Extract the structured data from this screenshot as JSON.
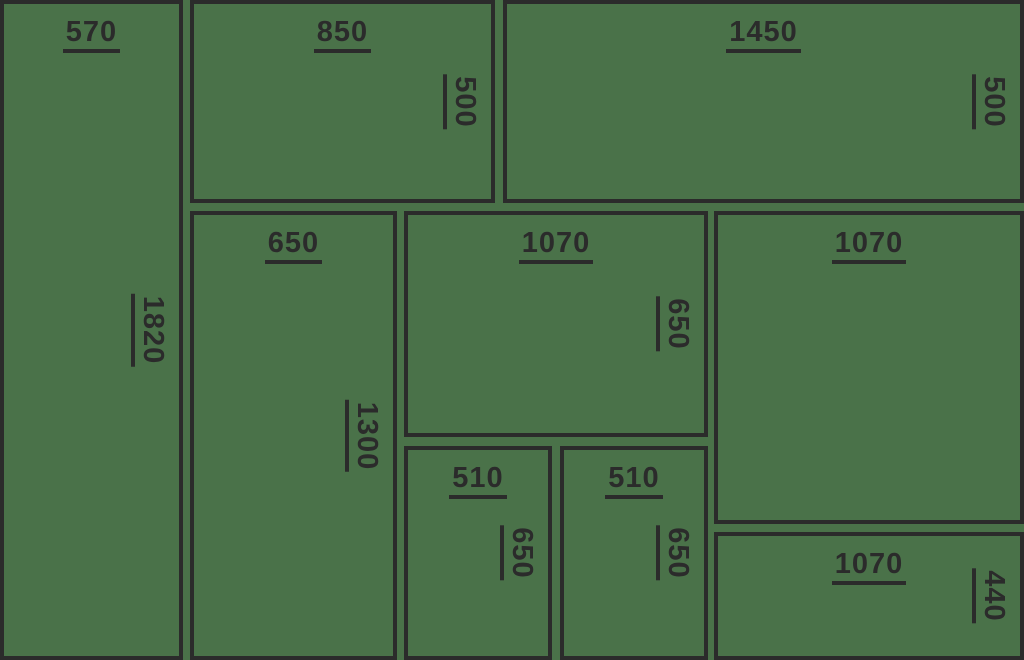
{
  "canvas": {
    "width_px": 1024,
    "height_px": 660,
    "background_color": "#4a7249",
    "line_color": "#2b2b2b"
  },
  "diagram": {
    "type": "panel-cutting-layout",
    "panels": [
      {
        "name": "panel-570x1820",
        "width_label": "570",
        "height_label": "1820",
        "x": 0,
        "y": 0,
        "w": 183,
        "h": 660
      },
      {
        "name": "panel-850x500",
        "width_label": "850",
        "height_label": "500",
        "x": 190,
        "y": 0,
        "w": 305,
        "h": 203
      },
      {
        "name": "panel-1450x500",
        "width_label": "1450",
        "height_label": "500",
        "x": 503,
        "y": 0,
        "w": 521,
        "h": 203
      },
      {
        "name": "panel-650x1300",
        "width_label": "650",
        "height_label": "1300",
        "x": 190,
        "y": 211,
        "w": 207,
        "h": 449
      },
      {
        "name": "panel-1070x650",
        "width_label": "1070",
        "height_label": "650",
        "x": 404,
        "y": 211,
        "w": 304,
        "h": 226
      },
      {
        "name": "panel-1070-right",
        "width_label": "1070",
        "height_label": null,
        "x": 714,
        "y": 211,
        "w": 310,
        "h": 313
      },
      {
        "name": "panel-510x650-left",
        "width_label": "510",
        "height_label": "650",
        "x": 404,
        "y": 446,
        "w": 148,
        "h": 214
      },
      {
        "name": "panel-510x650-right",
        "width_label": "510",
        "height_label": "650",
        "x": 560,
        "y": 446,
        "w": 148,
        "h": 214
      },
      {
        "name": "panel-1070x440",
        "width_label": "1070",
        "height_label": "440",
        "x": 714,
        "y": 532,
        "w": 310,
        "h": 128
      }
    ]
  }
}
